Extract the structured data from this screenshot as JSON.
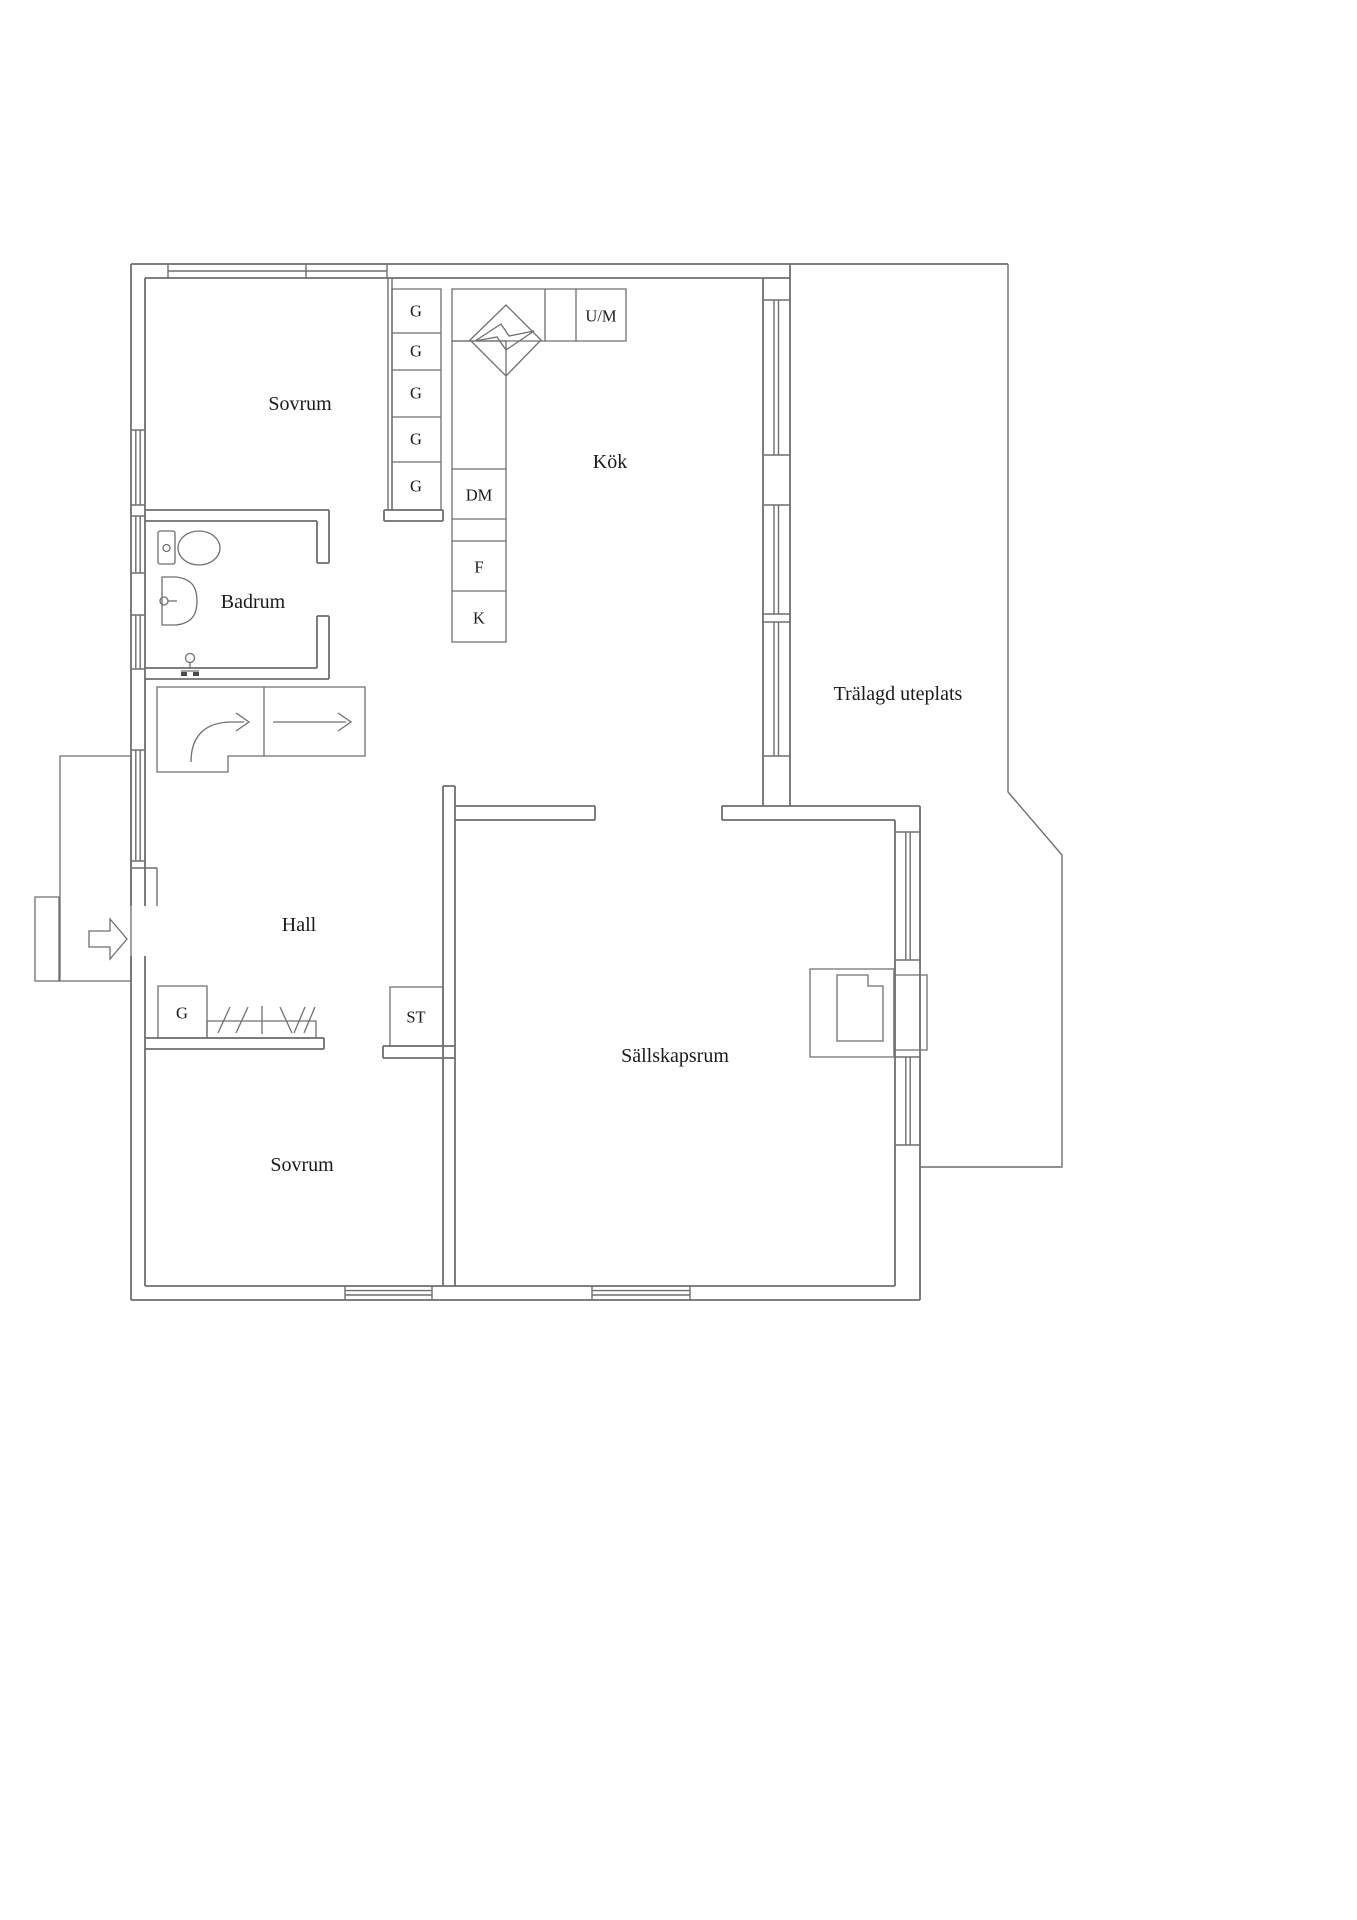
{
  "rooms": {
    "bedroom_top": "Sovrum",
    "kitchen": "Kök",
    "bathroom": "Badrum",
    "hall": "Hall",
    "living_room": "Sällskapsrum",
    "bedroom_bottom": "Sovrum",
    "patio": "Trälagd uteplats"
  },
  "kitchen_cabinets": [
    "G",
    "G",
    "G",
    "G",
    "G"
  ],
  "appliances": {
    "oven_microwave": "U/M",
    "dishwasher": "DM",
    "freezer": "F",
    "fridge": "K"
  },
  "closets": {
    "hall_wardrobe": "G",
    "cleaning_closet": "ST"
  },
  "colors": {
    "background": "#ffffff",
    "line": "#6f6f6f",
    "text": "#1a1a1a"
  }
}
